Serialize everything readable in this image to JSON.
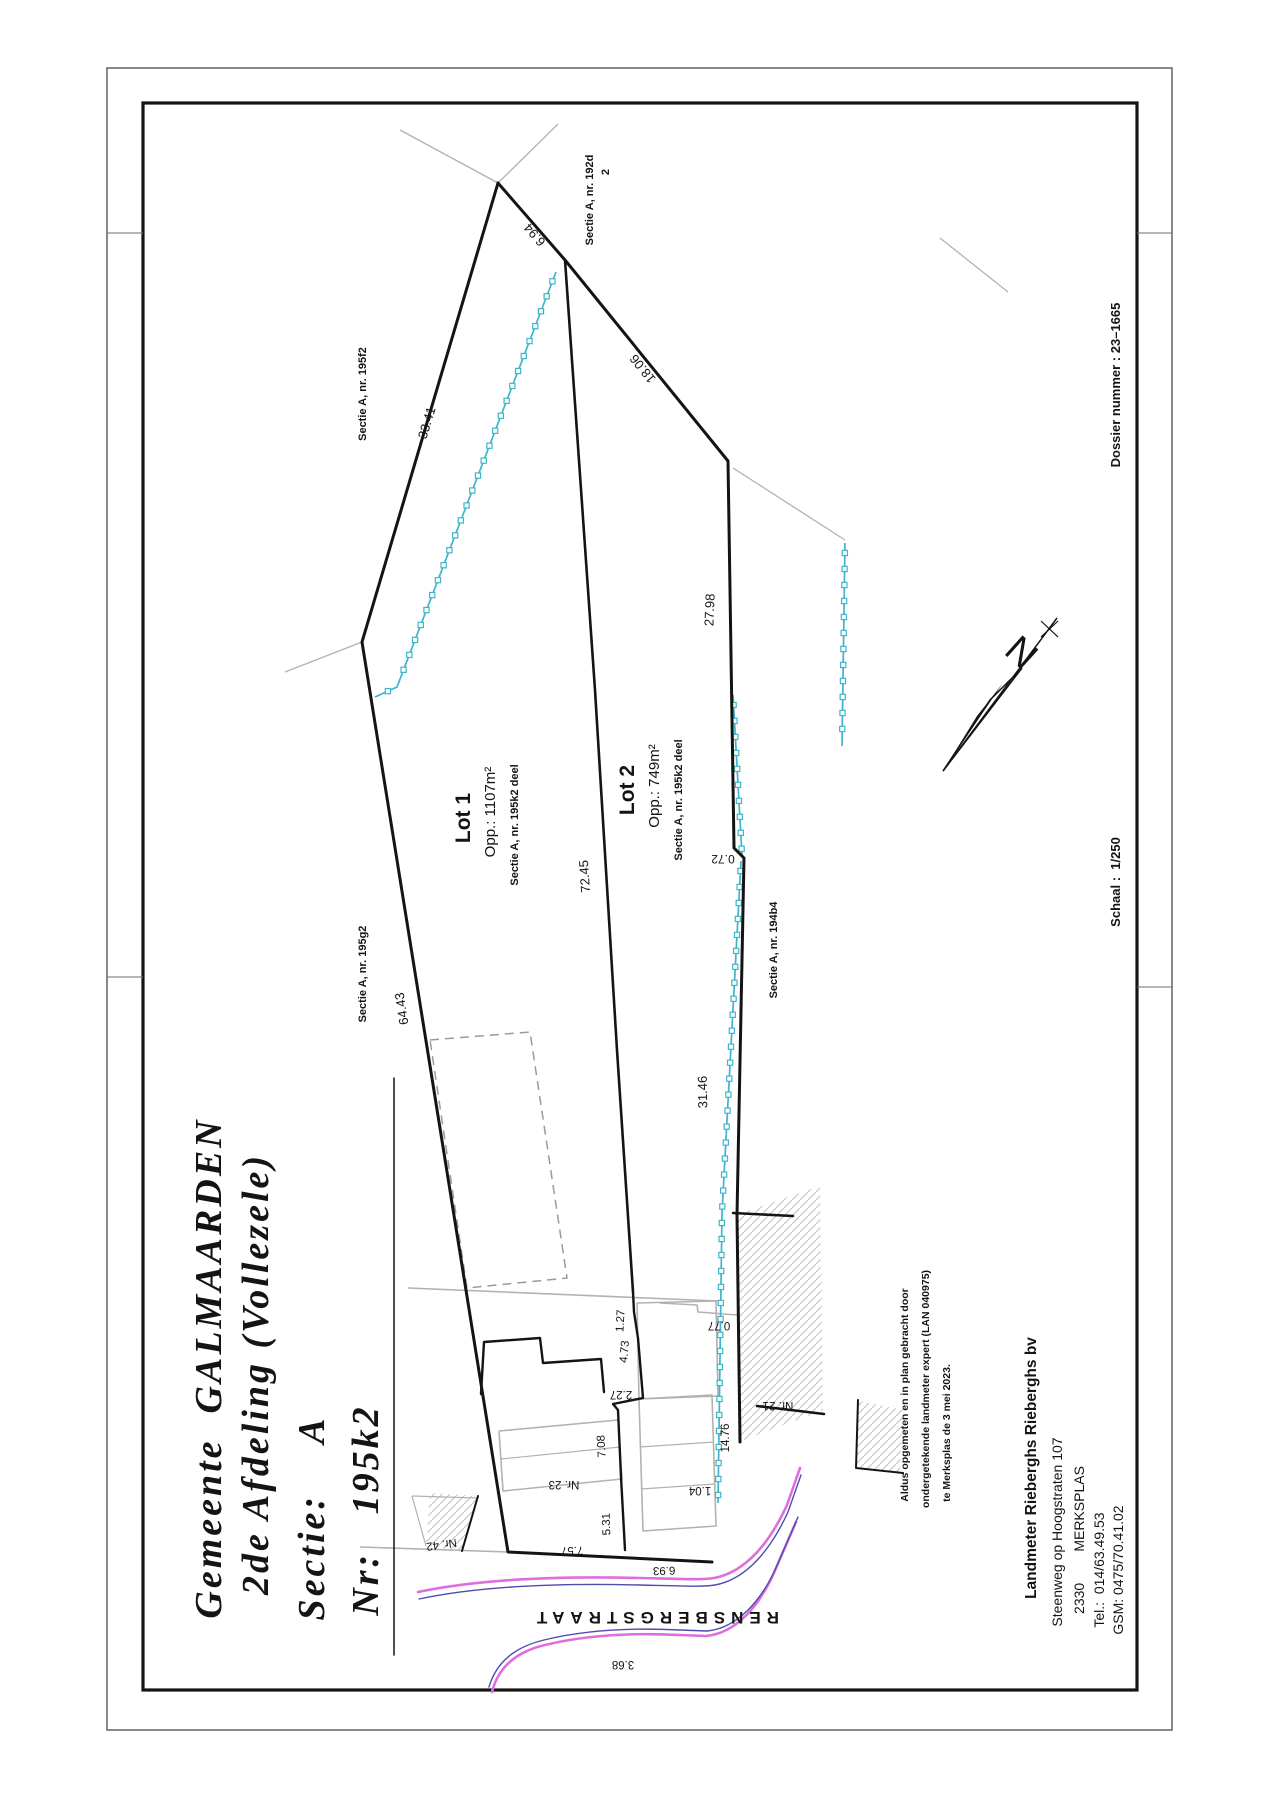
{
  "sheet": {
    "width": 1280,
    "height": 1809,
    "colors": {
      "ink": "#141414",
      "frame_outer": "#4a4a4a",
      "gray": "#b2b2b2",
      "hatch": "#c7c7c7",
      "dash": "#9a9a9a",
      "cyan": "#3cb6ca",
      "magenta": "#de6ede",
      "blue": "#4d4dae"
    },
    "frame": {
      "outer": [
        107,
        68,
        1065,
        1662
      ],
      "inner": [
        143,
        103,
        994,
        1587
      ],
      "fold_marks": [
        "107,233 143,233",
        "107,977 143,977",
        "1137,233 1172,233",
        "1137,987 1172,987"
      ]
    }
  },
  "texts": {
    "title": [
      {
        "t": "Gemeente  GALMAARDEN",
        "x": 221,
        "y": 1368,
        "r": -90,
        "s": 38,
        "b": 1,
        "i": 1,
        "sf": 1,
        "ls": 3
      },
      {
        "t": "2de Afdeling (Vollezele)",
        "x": 268,
        "y": 1374,
        "r": -90,
        "s": 38,
        "b": 1,
        "i": 1,
        "sf": 1,
        "ls": 3
      },
      {
        "t": "Sectie:    A",
        "x": 324,
        "y": 1518,
        "r": -90,
        "s": 38,
        "b": 1,
        "i": 1,
        "sf": 1,
        "ls": 3
      },
      {
        "t": "Nr:   195k2",
        "x": 378,
        "y": 1510,
        "r": -90,
        "s": 38,
        "b": 1,
        "i": 1,
        "sf": 1,
        "ls": 3
      }
    ],
    "margin": [
      {
        "t": "Dossier nummer : 23–1665",
        "x": 1120,
        "y": 385,
        "r": -90,
        "s": 13,
        "b": 1
      },
      {
        "t": "Schaal :  1/250",
        "x": 1120,
        "y": 882,
        "r": -90,
        "s": 13,
        "b": 1
      }
    ],
    "statement": [
      {
        "t": "Aldus opgemeten en in plan gebracht door",
        "x": 908,
        "y": 1395,
        "r": -90,
        "s": 10.5,
        "b": 1
      },
      {
        "t": "ondergetekende landmeter expert (LAN 040975)",
        "x": 929,
        "y": 1389,
        "r": -90,
        "s": 10.5,
        "b": 1
      },
      {
        "t": "te Merksplas de 3 mei 2023.",
        "x": 950,
        "y": 1433,
        "r": -90,
        "s": 10.5,
        "b": 1
      }
    ],
    "company": [
      {
        "t": "Landmeter Rieberghs Rieberghs bv",
        "x": 1036,
        "y": 1468,
        "r": -90,
        "s": 15.5,
        "b": 1
      },
      {
        "t": "Steenweg op Hoogstraten 107",
        "x": 1062,
        "y": 1532,
        "r": -90,
        "s": 14
      },
      {
        "t": "2330        MERKSPLAS",
        "x": 1084,
        "y": 1540,
        "r": -90,
        "s": 14
      },
      {
        "t": "Tel.:  014/63.49.53",
        "x": 1104,
        "y": 1570,
        "r": -90,
        "s": 14
      },
      {
        "t": "GSM: 0475/70.41.02",
        "x": 1123,
        "y": 1570,
        "r": -90,
        "s": 14
      }
    ],
    "plan_labels": [
      {
        "t": "6.94",
        "x": 538,
        "y": 232,
        "r": -131,
        "s": 13
      },
      {
        "t": "18.06",
        "x": 646,
        "y": 366,
        "r": -129,
        "s": 13
      },
      {
        "t": "33.41",
        "x": 431,
        "y": 424,
        "r": -73,
        "s": 13
      },
      {
        "t": "27.98",
        "x": 714,
        "y": 610,
        "r": -88,
        "s": 13
      },
      {
        "t": "0.72",
        "x": 723,
        "y": 855,
        "r": 180,
        "s": 12
      },
      {
        "t": "64.43",
        "x": 406,
        "y": 1008,
        "r": -99,
        "s": 13
      },
      {
        "t": "72.45",
        "x": 589,
        "y": 876,
        "r": -94,
        "s": 13
      },
      {
        "t": "31.46",
        "x": 707,
        "y": 1092,
        "r": -91,
        "s": 13
      },
      {
        "t": "1.27",
        "x": 624,
        "y": 1321,
        "r": -87,
        "s": 11.5
      },
      {
        "t": "4.73",
        "x": 628,
        "y": 1352,
        "r": -85,
        "s": 11.5
      },
      {
        "t": "2.27",
        "x": 621,
        "y": 1391,
        "r": 180,
        "s": 11.5
      },
      {
        "t": "7.08",
        "x": 605,
        "y": 1446,
        "r": -93,
        "s": 11.5
      },
      {
        "t": "0.77",
        "x": 719,
        "y": 1322,
        "r": 180,
        "s": 11.5
      },
      {
        "t": "14.76",
        "x": 729,
        "y": 1438,
        "r": -90,
        "s": 11.5
      },
      {
        "t": "5.31",
        "x": 610,
        "y": 1524,
        "r": -92,
        "s": 11.5
      },
      {
        "t": "7.57",
        "x": 572,
        "y": 1547,
        "r": 178,
        "s": 11.5
      },
      {
        "t": "6.93",
        "x": 664,
        "y": 1567,
        "r": 178,
        "s": 11.5
      },
      {
        "t": "3.68",
        "x": 623,
        "y": 1661,
        "r": 180,
        "s": 11.5
      },
      {
        "t": "1.04",
        "x": 700,
        "y": 1487,
        "r": 180,
        "s": 11.5
      },
      {
        "t": "Nr. 23",
        "x": 564,
        "y": 1481,
        "r": 180,
        "s": 11.5
      },
      {
        "t": "Nr. 21",
        "x": 778,
        "y": 1402,
        "r": 180,
        "s": 11.5
      },
      {
        "t": "Nr. 42",
        "x": 441,
        "y": 1541,
        "r": 172,
        "s": 11.5
      },
      {
        "t": "Sectie A, nr. 192d",
        "x": 593,
        "y": 200,
        "r": -90,
        "s": 11,
        "b": 1
      },
      {
        "t": "2",
        "x": 609,
        "y": 172,
        "r": -90,
        "s": 11,
        "b": 1
      },
      {
        "t": "Sectie A, nr. 195f2",
        "x": 366,
        "y": 394,
        "r": -90,
        "s": 11,
        "b": 1
      },
      {
        "t": "Sectie A, nr. 195g2",
        "x": 366,
        "y": 974,
        "r": -90,
        "s": 11,
        "b": 1
      },
      {
        "t": "Sectie A, nr. 194b4",
        "x": 777,
        "y": 950,
        "r": -90,
        "s": 11,
        "b": 1
      },
      {
        "t": "Lot 1",
        "x": 470,
        "y": 818,
        "r": -90,
        "s": 21,
        "b": 1
      },
      {
        "t": "Opp.: 1107m²",
        "x": 495,
        "y": 812,
        "r": -90,
        "s": 15
      },
      {
        "t": "Sectie A, nr. 195k2 deel",
        "x": 518,
        "y": 825,
        "r": -90,
        "s": 11,
        "b": 1
      },
      {
        "t": "Lot 2",
        "x": 634,
        "y": 790,
        "r": -90,
        "s": 21,
        "b": 1
      },
      {
        "t": "Opp.: 749m²",
        "x": 659,
        "y": 786,
        "r": -90,
        "s": 15
      },
      {
        "t": "Sectie A, nr. 195k2 deel",
        "x": 682,
        "y": 800,
        "r": -90,
        "s": 11,
        "b": 1
      },
      {
        "t": "RENSBERGSTRAAT",
        "x": 655,
        "y": 1612,
        "r": 180,
        "s": 17,
        "b": 1,
        "ls": 6
      }
    ]
  },
  "plan": {
    "black_lines": [
      {
        "p": "498,183 362,642 508,1552 712,1562",
        "w": 3
      },
      {
        "p": "498,183 565,260 728,461 734,848 744,858 737,1215 740,1442",
        "w": 3
      },
      {
        "p": "565,260 595,690 617,1050 633,1292",
        "w": 2.6
      },
      {
        "p": "633,1292 634,1312 638,1338 643,1398 613,1404 618,1410 621,1477 625,1550",
        "w": 2.4
      },
      {
        "p": "481,1394 484,1342 540,1338 543,1363 601,1359 604,1392",
        "w": 2.4
      },
      {
        "p": "733,1213 793,1216",
        "w": 2.6
      },
      {
        "p": "757,1406 824,1414",
        "w": 2.6
      },
      {
        "p": "478,1496 462,1551",
        "w": 2
      },
      {
        "p": "858,1400 856,1468 903,1473",
        "w": 2
      },
      {
        "p": "394,1078 394,1655",
        "w": 1.5
      }
    ],
    "gray_lines": [
      {
        "p": "400,130 498,183 558,124",
        "w": 1.3
      },
      {
        "p": "285,672 362,642",
        "w": 1.3
      },
      {
        "p": "733,468 845,540",
        "w": 1.3
      },
      {
        "p": "940,238 1008,292",
        "w": 1.3
      },
      {
        "p": "408,1288 718,1301",
        "w": 1.6
      },
      {
        "p": "360,1547 508,1552",
        "w": 1.6
      },
      {
        "p": "499,1431 618,1420 622,1479 503,1491 499,1431",
        "w": 1.6
      },
      {
        "p": "501,1459 620,1447",
        "w": 1.2
      },
      {
        "p": "637,1303 716,1301 718,1396 639,1399 637,1303",
        "w": 1.6
      },
      {
        "p": "639,1399 712,1395 716,1526 643,1531 639,1399",
        "w": 1.6
      },
      {
        "p": "640,1447 714,1442",
        "w": 1.2
      },
      {
        "p": "641,1489 715,1484",
        "w": 1.2
      },
      {
        "p": "660,1303 697,1305 698,1312 737,1315",
        "w": 1.6
      },
      {
        "p": "412,1496 478,1498",
        "w": 1.2
      },
      {
        "p": "412,1496 426,1546",
        "w": 1.2
      }
    ],
    "dashed_lines": [
      {
        "p": "430,1040 530,1032 567,1278 467,1288 430,1040",
        "w": 1.5
      }
    ],
    "hatch_polys": [
      "736,1215 820,1186 823,1410 741,1441",
      "430,1493 478,1496 462,1551 426,1546",
      "859,1401 903,1410 900,1472 856,1468"
    ],
    "fences": [
      "556,272 397,687 375,697",
      "733,695 742,855",
      "741,861 722,1213 718,1503",
      "845,543 842,746"
    ],
    "streets": {
      "magenta": [
        "M418,1592 C480,1579 560,1576 640,1578 C680,1579 702,1580 714,1578 C747,1572 771,1540 787,1505 L800,1468",
        "M492,1692 C498,1668 515,1652 545,1645 C590,1634 640,1633 680,1635 L706,1636 C737,1633 759,1605 773,1575 L796,1522"
      ],
      "blue": [
        "M419,1599 C480,1586 560,1583 640,1585 C681,1586 703,1587 715,1585 C748,1579 772,1547 788,1512 L801,1475",
        "M489,1687 C496,1663 514,1647 544,1640 C589,1629 640,1628 680,1630 L707,1631 C738,1628 761,1600 775,1570 L798,1517"
      ]
    },
    "north_arrow": {
      "shaft": "M943,771 L1057,618",
      "head_fill": "943,771 1003,683 977,716",
      "head_open": "943,771 1022,668 990,700",
      "tick": "M1041,621 L1058,637 M1058,621 L1041,637",
      "letter": "N",
      "n_x": 1013,
      "n_y": 662,
      "n_rot": 42,
      "n_size": 38
    }
  }
}
